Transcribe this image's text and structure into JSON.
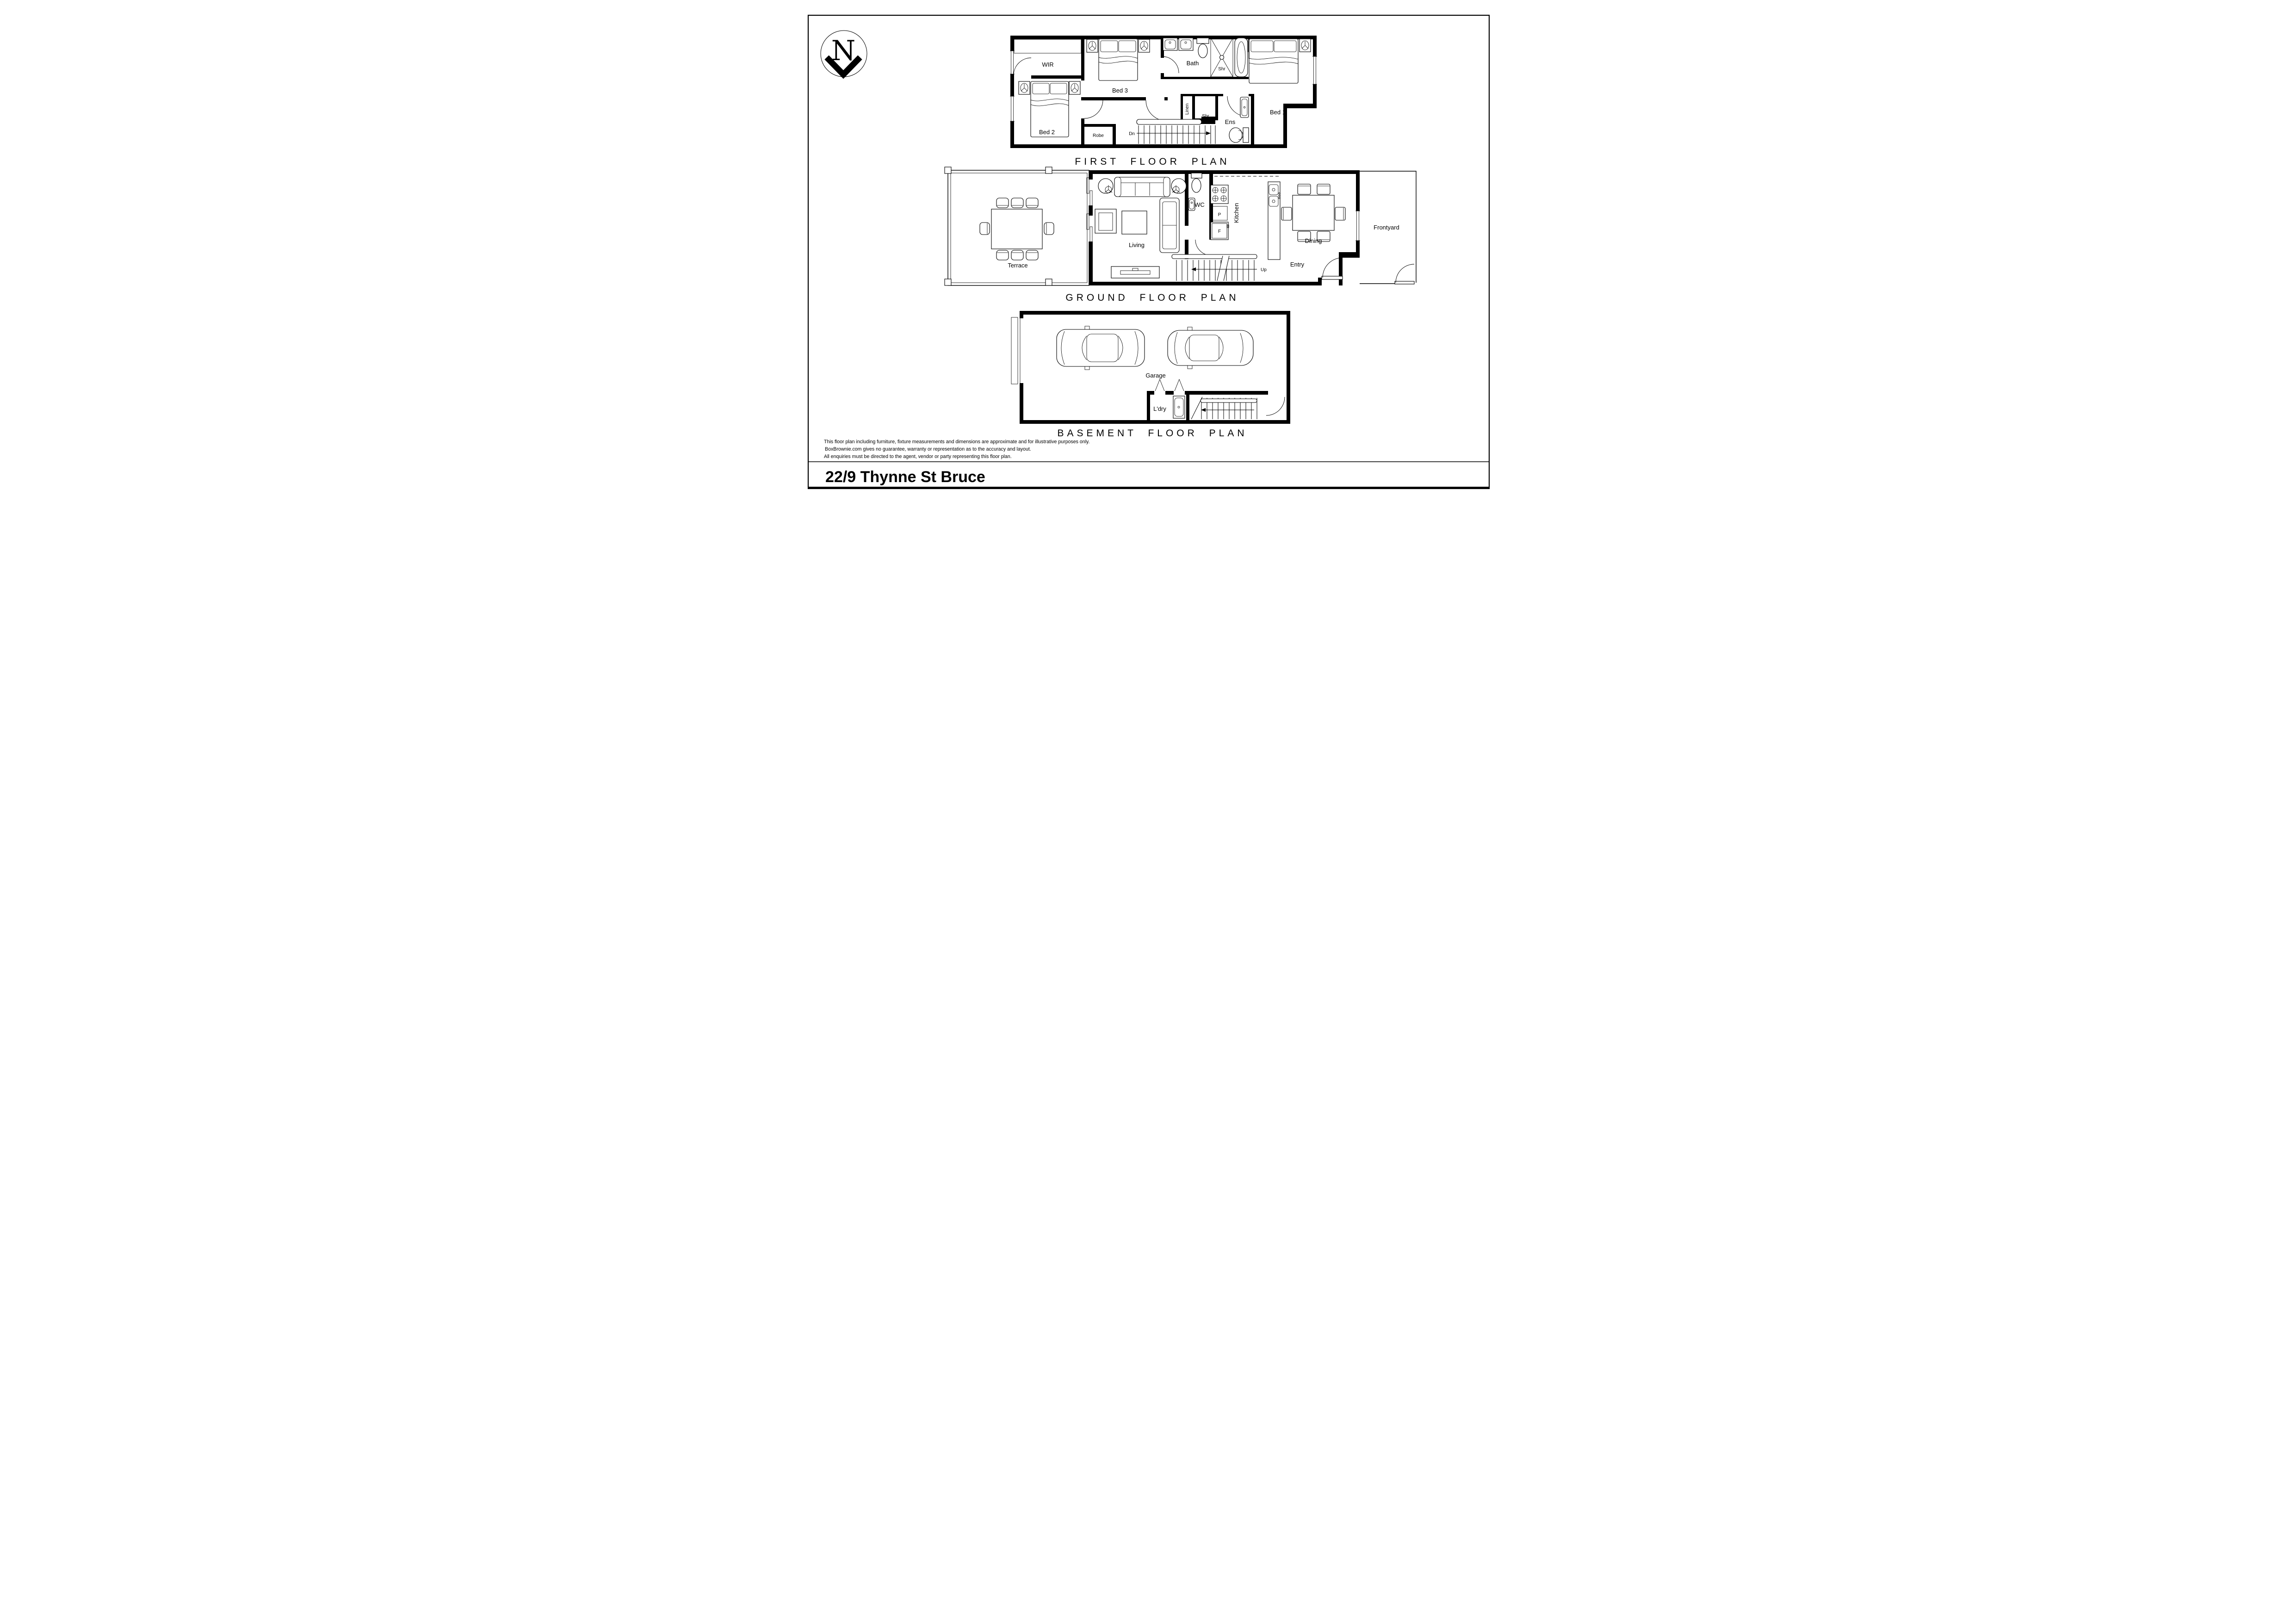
{
  "page": {
    "north_label": "N",
    "title": "22/9 Thynne St Bruce",
    "colors": {
      "ink": "#000000",
      "paper": "#ffffff"
    },
    "disclaimer_lines": {
      "line1": "This floor plan including furniture, fixture measurements and dimensions are approximate and for illustrative purposes only.",
      "line2": "BoxBrownie.com gives no guarantee, warranty or representation as to the accuracy and layout.",
      "line3": "All enquiries must be directed to the agent, vendor or party representing this floor plan."
    }
  },
  "plans": {
    "first": {
      "title": "FIRST FLOOR PLAN",
      "labels": {
        "wir": "WIR",
        "bed3": "Bed 3",
        "bath": "Bath",
        "shr_bath": "Shr",
        "bed1": "Bed 1",
        "bed2": "Bed 2",
        "robe": "Robe",
        "dn": "Dn",
        "linen": "Linen",
        "shr_ens": "Shr",
        "ens": "Ens"
      }
    },
    "ground": {
      "title": "GROUND FLOOR PLAN",
      "labels": {
        "terrace": "Terrace",
        "living": "Living",
        "wc": "WC",
        "pantry": "P",
        "fridge": "F",
        "kitchen": "Kitchen",
        "dining": "Dining",
        "entry": "Entry",
        "up": "Up",
        "frontyard": "Frontyard"
      }
    },
    "basement": {
      "title": "BASEMENT FLOOR PLAN",
      "labels": {
        "garage": "Garage",
        "ldry": "L'dry"
      }
    }
  }
}
